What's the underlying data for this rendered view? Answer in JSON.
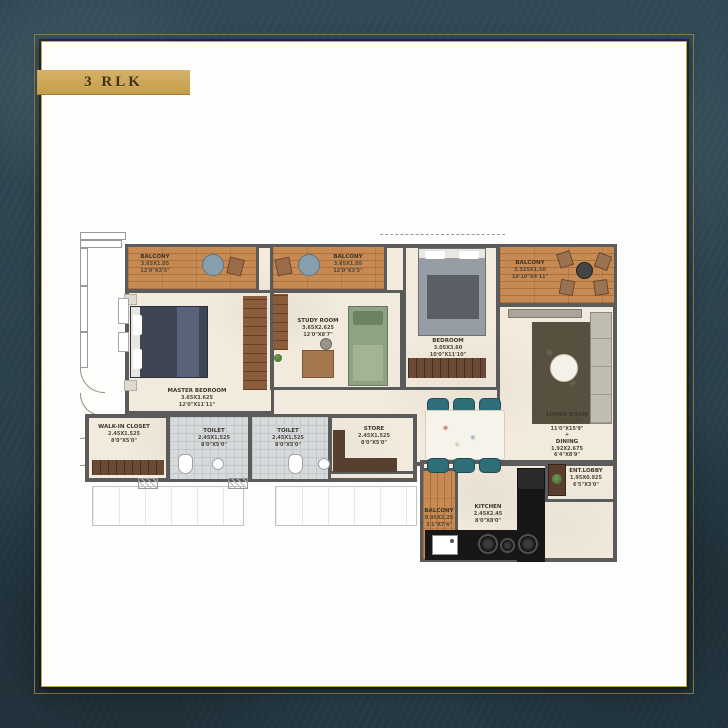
{
  "badge": {
    "label": "3 RLK"
  },
  "colors": {
    "background": "#2d4450",
    "frame_gold": "#c6a351",
    "wall": "#5b5b5b",
    "wood_floor": "#c78a53",
    "room_floor": "#f1eadd",
    "tile_floor": "#d6dadb",
    "chair_teal": "#2e6e79"
  },
  "rooms": {
    "balcony_tl": {
      "name": "BALCONY",
      "dim_m": "3.65X1.05",
      "dim_ft": "12'0\"X3'5\""
    },
    "balcony_mid": {
      "name": "BALCONY",
      "dim_m": "3.65X1.05",
      "dim_ft": "12'0\"X3'5\""
    },
    "balcony_tr": {
      "name": "BALCONY",
      "dim_m": "3.325X1.50",
      "dim_ft": "10'10\"X4'11\""
    },
    "master_bedroom": {
      "name": "MASTER BEDROOM",
      "dim_m": "3.65X3.625",
      "dim_ft": "12'0\"X11'11\""
    },
    "study_room": {
      "name": "STUDY ROOM",
      "dim_m": "3.65X2.625",
      "dim_ft": "12'0\"X8'7\""
    },
    "bedroom": {
      "name": "BEDROOM",
      "dim_m": "3.05X3.60",
      "dim_ft": "10'0\"X11'10\""
    },
    "living_room": {
      "name": "LIVING ROOM",
      "dim_m": "3.35X4.80",
      "dim_ft": "11'0\"X15'9\"",
      "joiner": "+",
      "name2": "DINING",
      "dim2_m": "1.92X2.675",
      "dim2_ft": "6'4\"X8'9\""
    },
    "walk_in_closet": {
      "name": "WALK-IN CLOSET",
      "dim_m": "2.45X1.525",
      "dim_ft": "8'0\"X5'0\""
    },
    "toilet_1": {
      "name": "TOILET",
      "dim_m": "2.45X1.525",
      "dim_ft": "8'0\"X5'0\""
    },
    "toilet_2": {
      "name": "TOILET",
      "dim_m": "2.45X1.525",
      "dim_ft": "8'0\"X5'0\""
    },
    "store": {
      "name": "STORE",
      "dim_m": "2.45X1.525",
      "dim_ft": "8'0\"X5'0\""
    },
    "ent_lobby": {
      "name": "ENT.LOBBY",
      "dim_m": "1.95X0.925",
      "dim_ft": "6'5\"X3'0\""
    },
    "kitchen": {
      "name": "KITCHEN",
      "dim_m": "2.45X2.45",
      "dim_ft": "8'0\"X8'0\""
    },
    "balcony_bottom": {
      "name": "BALCONY",
      "dim_m": "0.95X2.25",
      "dim_ft": "3'1\"X7'4\""
    }
  }
}
